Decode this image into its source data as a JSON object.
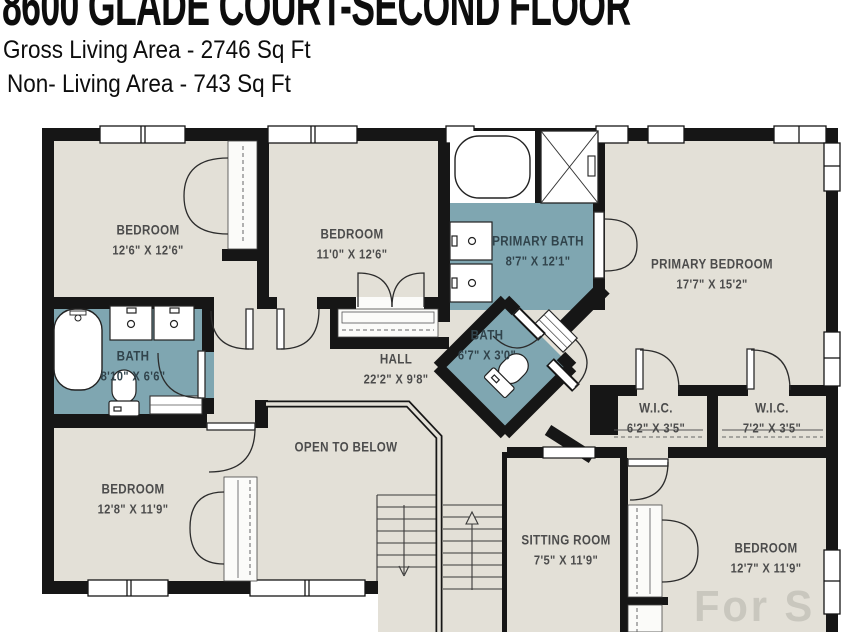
{
  "header": {
    "title": "8600 GLADE COURT-SECOND FLOOR",
    "gross": "Gross Living Area - 2746 Sq Ft",
    "non_living": "Non- Living Area - 743 Sq Ft"
  },
  "rooms": [
    {
      "name": "BEDROOM",
      "dims": "12'6\" X 12'6\""
    },
    {
      "name": "BEDROOM",
      "dims": "11'0\" X 12'6\""
    },
    {
      "name": "PRIMARY BATH",
      "dims": "8'7\" X 12'1\""
    },
    {
      "name": "PRIMARY BEDROOM",
      "dims": "17'7\" X 15'2\""
    },
    {
      "name": "BATH",
      "dims": "8'10\" X 6'6\""
    },
    {
      "name": "HALL",
      "dims": "22'2\" X 9'8\""
    },
    {
      "name": "BATH",
      "dims": "6'7\" X 3'0\""
    },
    {
      "name": "W.I.C.",
      "dims": "6'2\" X 3'5\""
    },
    {
      "name": "W.I.C.",
      "dims": "7'2\" X 3'5\""
    },
    {
      "name": "OPEN TO BELOW",
      "dims": ""
    },
    {
      "name": "BEDROOM",
      "dims": "12'8\" X 11'9\""
    },
    {
      "name": "SITTING ROOM",
      "dims": "7'5\" X 11'9\""
    },
    {
      "name": "BEDROOM",
      "dims": "12'7\" X 11'9\""
    }
  ],
  "watermark": "For S",
  "colors": {
    "room": "#e3e0d7",
    "bath": "#7fa6b1",
    "wall": "#161616",
    "label": "#4c4c4c"
  }
}
